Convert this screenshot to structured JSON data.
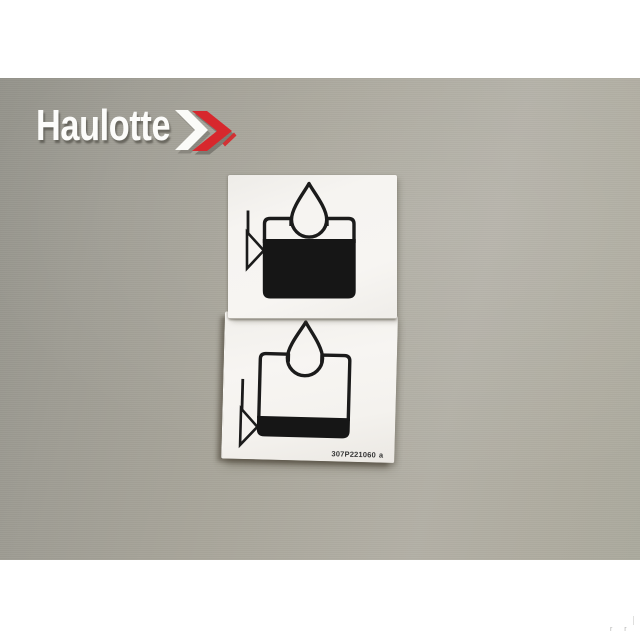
{
  "logo": {
    "brand": "Haulotte",
    "chevron_icon": "double-chevron-right-icon",
    "red": "#d7282d",
    "text_color": "#fcfcfa"
  },
  "sticker": {
    "part_number": "307P221060",
    "revision": "a",
    "top_label_icon": "hydraulic-oil-tank-full-icon",
    "bottom_label_icon": "hydraulic-oil-tank-low-icon"
  },
  "watermark": {
    "text": "r r"
  },
  "colors": {
    "background_top": "#95948c",
    "background_bottom": "#b2afa4",
    "label_white": "#f5f3f0",
    "symbol_black": "#1b1b1b"
  }
}
